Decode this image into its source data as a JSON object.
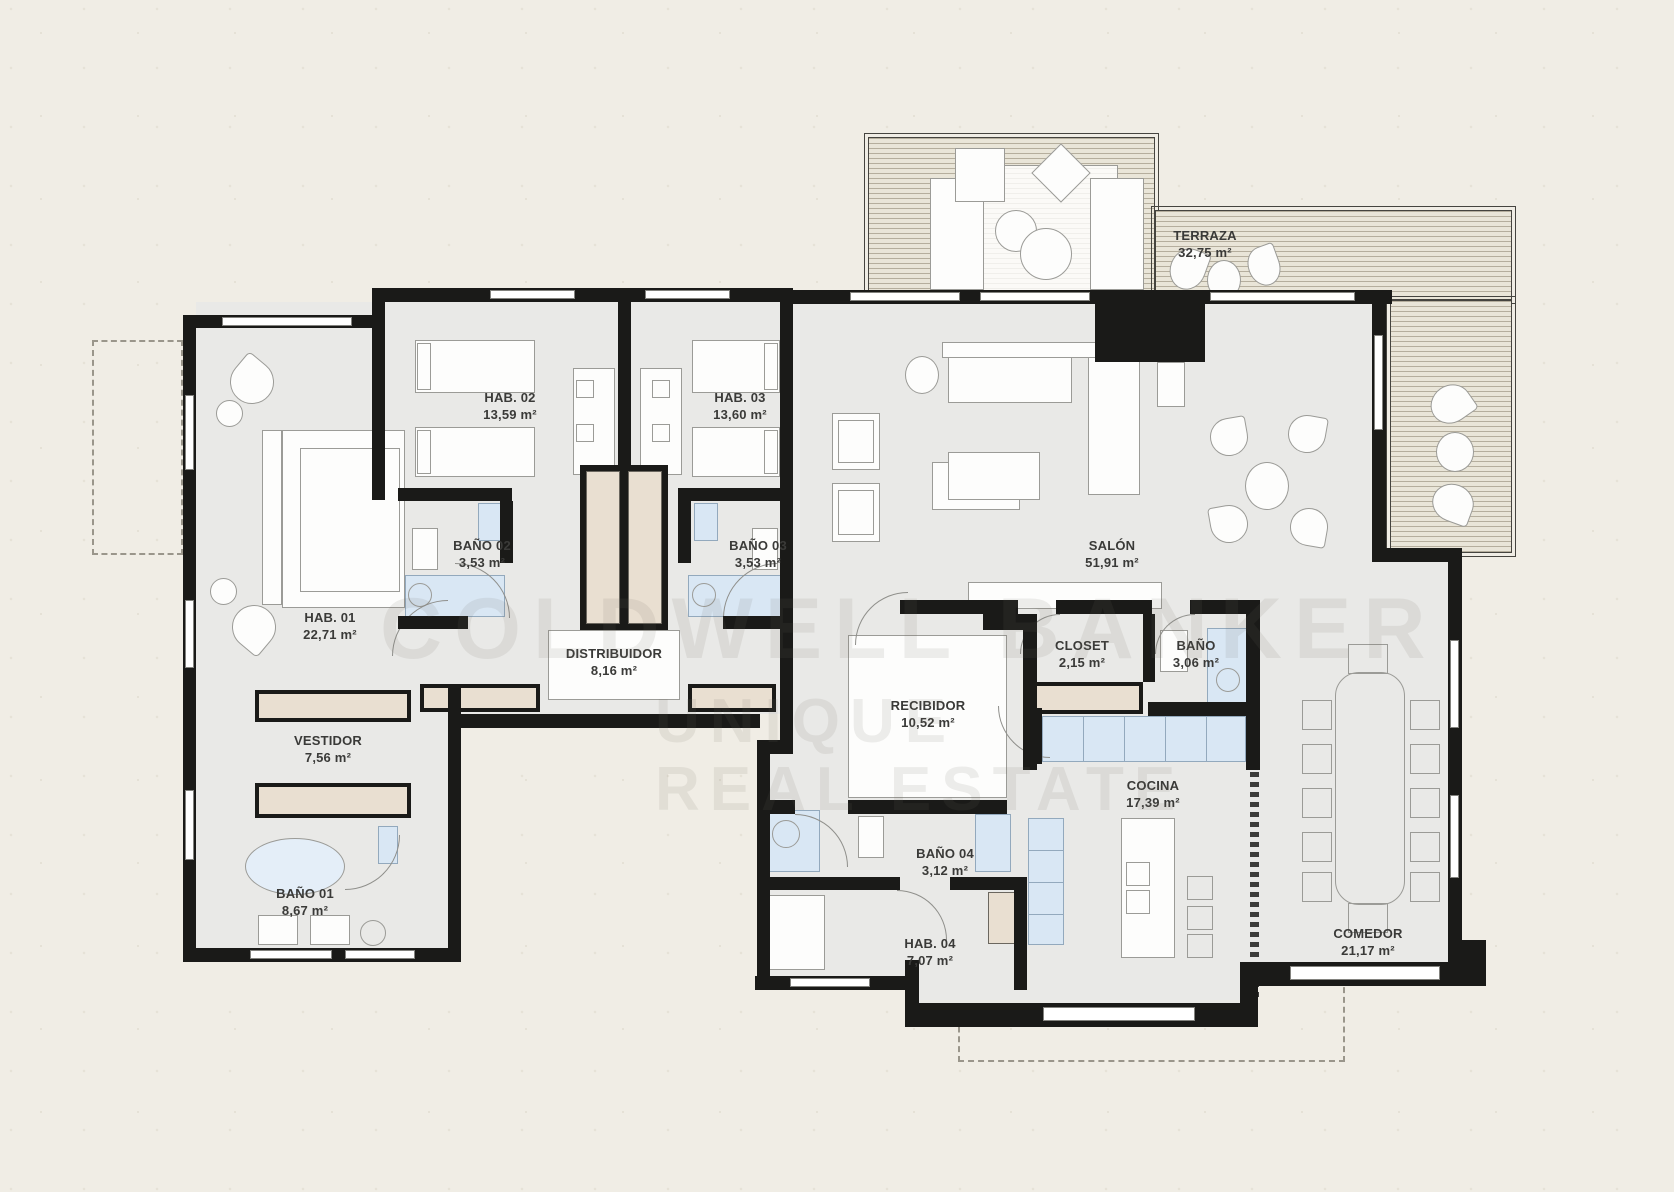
{
  "plan_title": "apartment-floor-plan",
  "watermark": {
    "line1": "COLDWELL BANKER",
    "line2": "UNIQUE",
    "line3": "REAL ESTATE"
  },
  "rooms": [
    {
      "id": "terraza",
      "name": "TERRAZA",
      "area": "32,75 m²"
    },
    {
      "id": "hab02",
      "name": "HAB. 02",
      "area": "13,59 m²"
    },
    {
      "id": "hab03",
      "name": "HAB. 03",
      "area": "13,60 m²"
    },
    {
      "id": "bano02",
      "name": "BAÑO 02",
      "area": "3,53 m²"
    },
    {
      "id": "bano03",
      "name": "BAÑO 03",
      "area": "3,53 m²"
    },
    {
      "id": "hab01",
      "name": "HAB. 01",
      "area": "22,71 m²"
    },
    {
      "id": "distribuidor",
      "name": "DISTRIBUIDOR",
      "area": "8,16 m²"
    },
    {
      "id": "salon",
      "name": "SALÓN",
      "area": "51,91 m²"
    },
    {
      "id": "recibidor",
      "name": "RECIBIDOR",
      "area": "10,52 m²"
    },
    {
      "id": "closet",
      "name": "CLOSET",
      "area": "2,15 m²"
    },
    {
      "id": "bano",
      "name": "BAÑO",
      "area": "3,06 m²"
    },
    {
      "id": "vestidor",
      "name": "VESTIDOR",
      "area": "7,56 m²"
    },
    {
      "id": "bano01",
      "name": "BAÑO 01",
      "area": "8,67 m²"
    },
    {
      "id": "cocina",
      "name": "COCINA",
      "area": "17,39 m²"
    },
    {
      "id": "bano04",
      "name": "BAÑO 04",
      "area": "3,12 m²"
    },
    {
      "id": "hab04",
      "name": "HAB. 04",
      "area": "7,07 m²"
    },
    {
      "id": "comedor",
      "name": "COMEDOR",
      "area": "21,17 m²"
    }
  ],
  "colors": {
    "wall": "#1a1a18",
    "paper": "#f0ede5",
    "room_fill": "#e9e9e7",
    "fixture_blue": "#d9e7f4",
    "wood_beige": "#e9dfd1",
    "deck_stripe": "#b5ae9d",
    "label_text": "#3a3a38"
  }
}
